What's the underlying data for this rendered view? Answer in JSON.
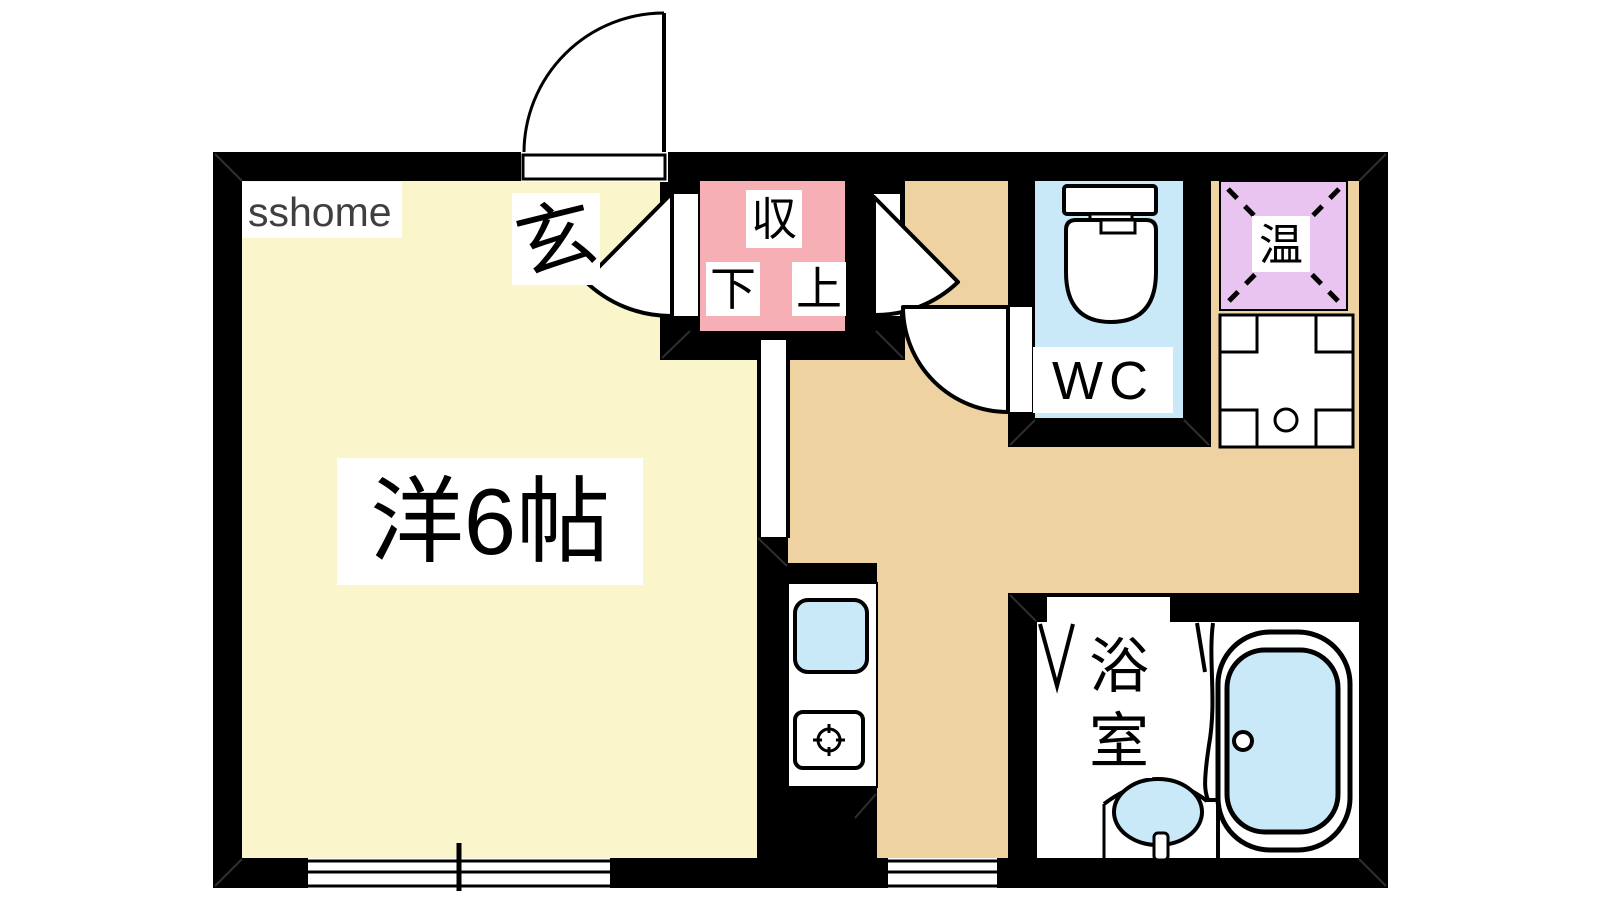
{
  "title": "1R apartment floor plan",
  "watermark": "sshome",
  "colors": {
    "wall": "#000000",
    "main_room": "#FBF5CB",
    "kitchen": "#EFD2A2",
    "closet": "#F6AFB5",
    "water": "#C9E9F9",
    "heater": "#EAC4F1"
  },
  "labels": {
    "main_room": "洋6帖",
    "entrance": "玄",
    "closet": "収",
    "closet_lower": "下",
    "closet_upper": "上",
    "wc": "WC",
    "water_heater": "温",
    "bath": "浴室",
    "bath_chars": [
      "浴",
      "室"
    ]
  }
}
